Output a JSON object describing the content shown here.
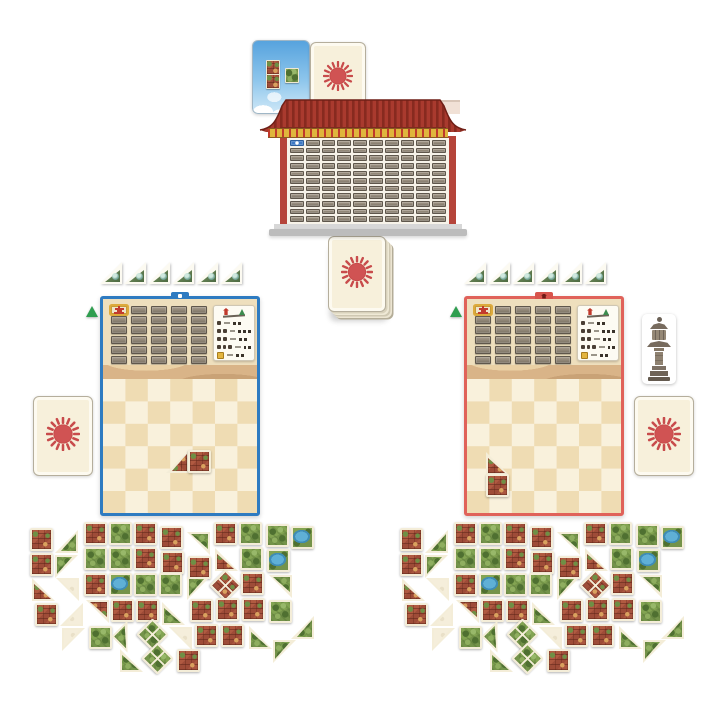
{
  "table": {
    "background": "#ffffff"
  },
  "palette": {
    "sun": "#d05353",
    "sun_ray": "#c84b4b",
    "card_cream": "#f7f0db",
    "roof_red": "#a93a2e",
    "roof_ridge": "#872a1f",
    "gold_trim": "#dfb63c",
    "pillar_red": "#b5443a",
    "blue_accent": "#2e7bc1",
    "red_accent": "#e0625a",
    "building_tile": "#a8533d",
    "garden_tile": "#7ea050",
    "pond": "#58aace",
    "board_tan": "#efdcb3",
    "board_cream": "#f9f1dc",
    "start_marker_green": "#2f9e50"
  },
  "components": {
    "sky_card": {
      "name": "preview-card-sky",
      "chips": [
        {
          "x": 13,
          "y": 19,
          "kind": "b"
        },
        {
          "x": 13,
          "y": 33,
          "kind": "b"
        },
        {
          "x": 32,
          "y": 27,
          "kind": "g"
        }
      ]
    },
    "sun_card": {
      "face": "red-sun",
      "single_cards_visible": 3,
      "deck_visible": true
    },
    "market_board": {
      "grid_rows": 11,
      "grid_cols": 10,
      "marker": "blue-round-marker"
    },
    "statue": {
      "name": "stone-pagoda-standee"
    }
  },
  "players": [
    {
      "id": "blue",
      "accent": "#2e7bc1",
      "pennants": 6,
      "placed_tiles": [
        [
          63,
          151,
          "tr",
          "b",
          270
        ],
        [
          85,
          151,
          "sq",
          "b",
          0
        ]
      ]
    },
    {
      "id": "red",
      "accent": "#e0625a",
      "pennants": 6,
      "placed_tiles": [
        [
          19,
          153,
          "tr",
          "b",
          0
        ],
        [
          19,
          175,
          "sq",
          "b",
          0
        ]
      ]
    }
  ],
  "player_board": {
    "mini_grid_rows": 6,
    "mini_grid_cols": 5,
    "checker_cols": 7,
    "reference_rows": [
      [
        1,
        2
      ],
      [
        2,
        3
      ],
      [
        2,
        2
      ],
      [
        3,
        2
      ],
      [
        1,
        2
      ]
    ]
  },
  "tile_piles": {
    "tiles": [
      [
        2,
        8,
        "sq",
        "b",
        0
      ],
      [
        27,
        10,
        "tr",
        "g",
        270
      ],
      [
        56,
        2,
        "sq",
        "b",
        0
      ],
      [
        81,
        2,
        "sq",
        "g",
        0
      ],
      [
        106,
        2,
        "sq",
        "b",
        0
      ],
      [
        132,
        6,
        "sq",
        "b",
        0
      ],
      [
        159,
        12,
        "tr",
        "g",
        180
      ],
      [
        186,
        2,
        "sq",
        "b",
        0
      ],
      [
        211,
        2,
        "sq",
        "g",
        0
      ],
      [
        238,
        4,
        "sq",
        "g",
        0
      ],
      [
        263,
        6,
        "sq",
        "p",
        0
      ],
      [
        2,
        33,
        "sq",
        "b",
        0
      ],
      [
        27,
        35,
        "tr",
        "g",
        90
      ],
      [
        56,
        27,
        "sq",
        "g",
        0
      ],
      [
        81,
        27,
        "sq",
        "g",
        0
      ],
      [
        106,
        27,
        "sq",
        "b",
        0
      ],
      [
        133,
        31,
        "sq",
        "b",
        0
      ],
      [
        160,
        36,
        "sq",
        "b",
        0
      ],
      [
        187,
        28,
        "tr",
        "b",
        0
      ],
      [
        212,
        27,
        "sq",
        "g",
        0
      ],
      [
        239,
        29,
        "sq",
        "p",
        0
      ],
      [
        4,
        58,
        "tr",
        "b",
        0
      ],
      [
        28,
        58,
        "tr",
        "w",
        180
      ],
      [
        56,
        53,
        "sq",
        "b",
        0
      ],
      [
        81,
        53,
        "sq",
        "p",
        0
      ],
      [
        106,
        53,
        "sq",
        "g",
        0
      ],
      [
        131,
        53,
        "sq",
        "g",
        0
      ],
      [
        159,
        57,
        "tr",
        "g",
        90
      ],
      [
        186,
        54,
        "dia",
        "b",
        45
      ],
      [
        213,
        52,
        "sq",
        "b",
        0
      ],
      [
        241,
        55,
        "tr",
        "g",
        180
      ],
      [
        7,
        83,
        "sq",
        "b",
        0
      ],
      [
        32,
        83,
        "tr",
        "w",
        270
      ],
      [
        58,
        80,
        "tr",
        "b",
        180
      ],
      [
        83,
        79,
        "sq",
        "b",
        0
      ],
      [
        108,
        79,
        "sq",
        "b",
        0
      ],
      [
        134,
        82,
        "tr",
        "g",
        0
      ],
      [
        162,
        79,
        "sq",
        "b",
        0
      ],
      [
        188,
        78,
        "sq",
        "b",
        0
      ],
      [
        214,
        78,
        "sq",
        "b",
        0
      ],
      [
        241,
        80,
        "sq",
        "g",
        0
      ],
      [
        34,
        108,
        "tr",
        "w",
        90
      ],
      [
        61,
        106,
        "sq",
        "g",
        0
      ],
      [
        88,
        105,
        "tr",
        "g",
        45
      ],
      [
        113,
        103,
        "dia",
        "g",
        45
      ],
      [
        141,
        107,
        "tr",
        "w",
        180
      ],
      [
        167,
        104,
        "sq",
        "b",
        0
      ],
      [
        193,
        104,
        "sq",
        "b",
        0
      ],
      [
        221,
        106,
        "tr",
        "g",
        0
      ],
      [
        263,
        96,
        "tr",
        "g",
        270
      ],
      [
        92,
        129,
        "tr",
        "g",
        0
      ],
      [
        118,
        127,
        "dia",
        "g",
        45
      ],
      [
        149,
        129,
        "sq",
        "b",
        0
      ],
      [
        245,
        120,
        "tr",
        "g",
        90
      ]
    ]
  }
}
